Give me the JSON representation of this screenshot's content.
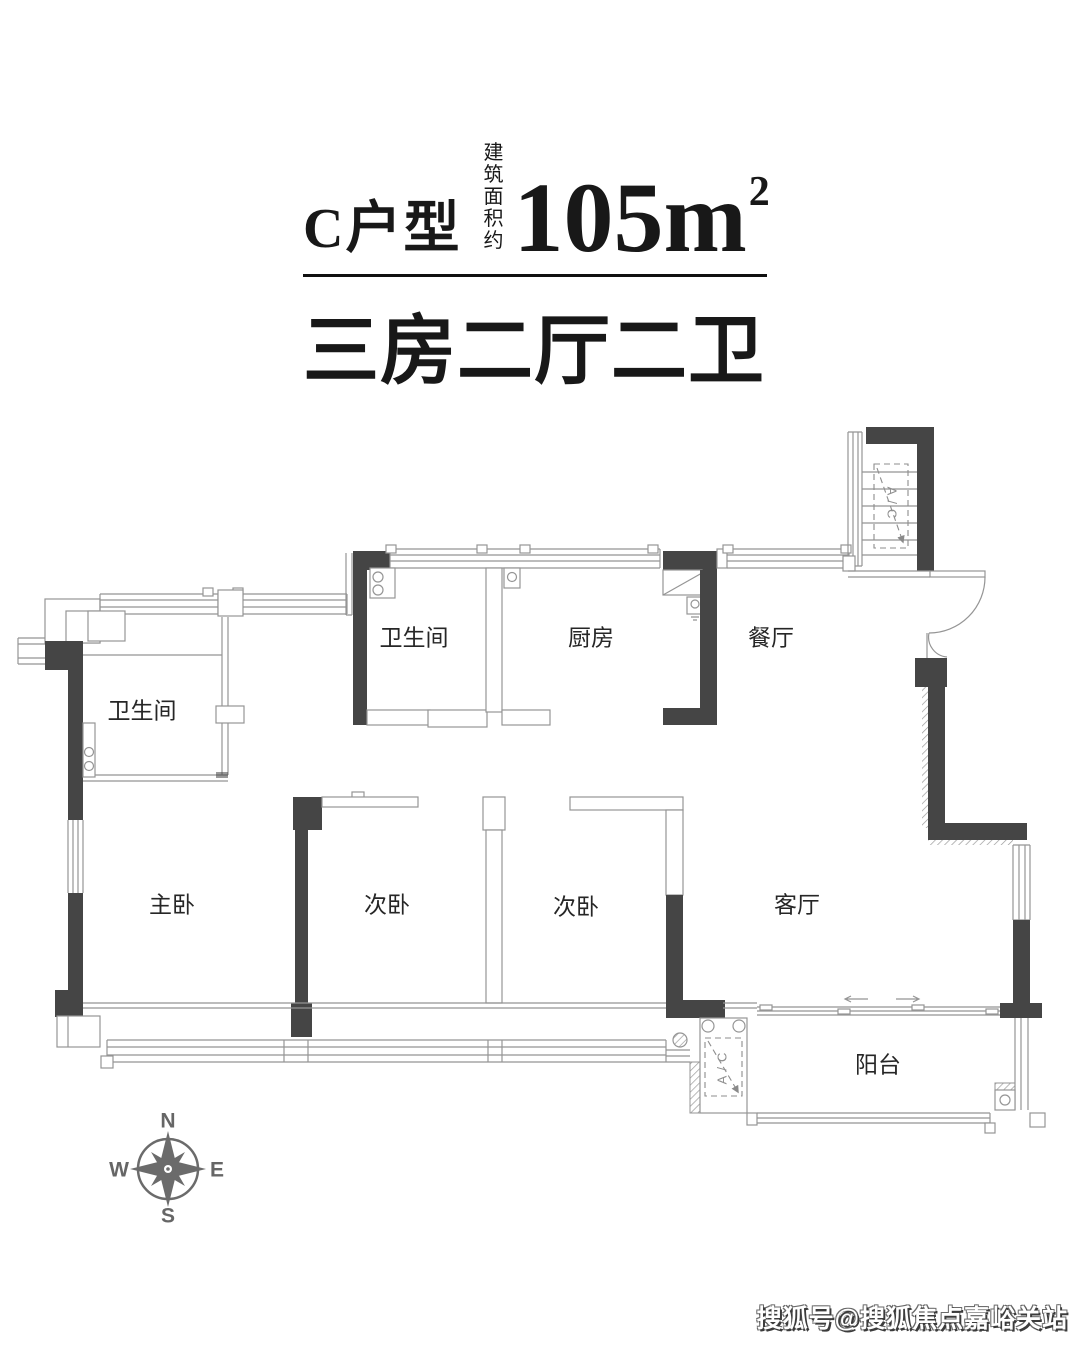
{
  "header": {
    "unit_name": "C户型",
    "area_note_line1": "建筑",
    "area_note_line2": "面积约",
    "area_value": "105m",
    "area_sup": "2",
    "subtitle": "三房二厅二卫"
  },
  "floorplan": {
    "rooms": [
      {
        "id": "bathroom-upper",
        "name": "卫生间"
      },
      {
        "id": "bathroom-lower",
        "name": "卫生间"
      },
      {
        "id": "kitchen",
        "name": "厨房"
      },
      {
        "id": "dining-room",
        "name": "餐厅"
      },
      {
        "id": "master-bedroom",
        "name": "主卧"
      },
      {
        "id": "bedroom-2",
        "name": "次卧"
      },
      {
        "id": "bedroom-3",
        "name": "次卧"
      },
      {
        "id": "living-room",
        "name": "客厅"
      },
      {
        "id": "balcony",
        "name": "阳台"
      }
    ],
    "ac_label": "A/C"
  },
  "compass": {
    "north": "N",
    "south": "S",
    "east": "E",
    "west": "W"
  },
  "watermark": "搜狐号@搜狐焦点嘉峪关站",
  "colors": {
    "wall": "#454545",
    "thin_line": "#959595",
    "text": "#181818",
    "compass": "#6b6b6b"
  }
}
